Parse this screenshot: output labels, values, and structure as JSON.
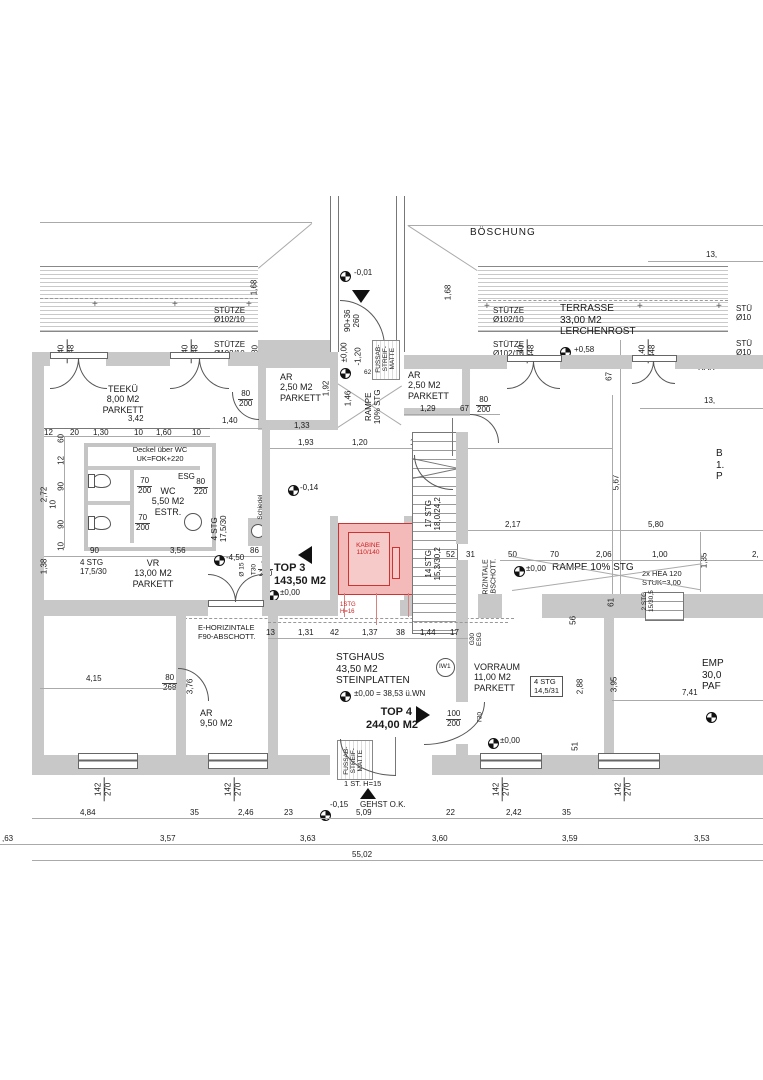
{
  "colors": {
    "wall": "#c8c8c8",
    "accent_red": "#cc3333"
  },
  "site": {
    "boeschung": "BÖSCHUNG",
    "dim_13a": "13,",
    "dim_13b": "13,",
    "rar": "RAR",
    "room_cut_1": "B",
    "room_cut_2": "1.",
    "room_cut_3": "P",
    "dim_2cut": "2,"
  },
  "rooms": {
    "terrasse": {
      "name": "TERRASSE",
      "area": "33,00 M2",
      "finish": "LERCHENROST"
    },
    "teekue": {
      "name": "TEEKÜ",
      "area": "8,00 M2",
      "finish": "PARKETT"
    },
    "ar_left": {
      "name": "AR",
      "area": "2,50 M2",
      "finish": "PARKETT"
    },
    "ar_right": {
      "name": "AR",
      "area": "2,50 M2",
      "finish": "PARKETT"
    },
    "wc": {
      "name": "WC",
      "area": "5,50 M2",
      "finish": "ESTR."
    },
    "vr": {
      "name": "VR",
      "area": "13,00 M2",
      "finish": "PARKETT"
    },
    "top3": {
      "name": "TOP 3",
      "area": "143,50 M2"
    },
    "top4": {
      "name": "TOP 4",
      "area": "244,00 M2"
    },
    "stghaus": {
      "name": "STGHAUS",
      "area": "43,50 M2",
      "finish": "STEINPLATTEN"
    },
    "vorraum": {
      "name": "VORRAUM",
      "area": "11,00 M2",
      "finish": "PARKETT"
    },
    "ar_bottom": {
      "name": "AR",
      "area": "9,50 M2"
    },
    "emp_cut": {
      "l1": "EMP",
      "l2": "30,0",
      "l3": "PAF"
    }
  },
  "columns": {
    "name": "STÜTZE",
    "size": "Ø102/10",
    "name_cut": "STÜ",
    "size_cut": "Ø10"
  },
  "elevator": {
    "name": "KABINE",
    "size": "110/140",
    "note": "1STG\nH=16"
  },
  "stairs": {
    "flight17": {
      "l1": "17 STG",
      "l2": "18,0/24,2"
    },
    "flight14": {
      "l1": "14 STG",
      "l2": "15,3/30,2"
    },
    "wc4": {
      "l1": "4 STG",
      "l2": "17,5/30"
    },
    "vr4": {
      "l1": "4 STG",
      "l2": "17,5/30"
    },
    "vorraum4": {
      "l1": "4 STG",
      "l2": "14,5/31"
    },
    "ramp2": {
      "l1": "2 STG",
      "l2": "15/30,5"
    },
    "ramp_main": "RAMPE 10% STG",
    "ramp_entry": {
      "l1": "RAMPE",
      "l2": "10% STG"
    },
    "hea": {
      "l1": "2x HEA 120",
      "l2": "STUK=3,00"
    },
    "step_note": "1 ST. H=15"
  },
  "levels": {
    "m001": "-0,01",
    "p058": "+0,58",
    "m014": "-0,14",
    "top3_zero": "±0,00",
    "m450": "-4,50",
    "ramp_zero": "±0,00",
    "stg_zero": "±0,00 = 38,53 ü.WN",
    "vorraum_zero": "±0,00",
    "m015": "-0,15",
    "gehst": "GEHST O.K.",
    "entry_zero": "±0,00",
    "entry_m120": "-1,20"
  },
  "tech": {
    "deckel": {
      "l1": "Deckel über WC",
      "l2": "UK=FOK+220"
    },
    "esg": "ESG",
    "g30": {
      "l1": "G30",
      "l2": "ESG"
    },
    "schiedel": {
      "l1": "Schiedel",
      "l2": "AVANT 16"
    },
    "ehoriz_h": {
      "l1": "E-HORIZINTALE",
      "l2": "F90-ABSCHOTT."
    },
    "ehoriz_v": {
      "l1": "E-HORIZINTALE",
      "l2": "F90-ABSCHOTT."
    },
    "mat": {
      "l1": "FUSSAB-",
      "l2": "STREIF-",
      "l3": "MATTE"
    },
    "iw1": "IW1",
    "t30_a": "T30",
    "t30_b": "T30",
    "o15": "Ø 15",
    "door_entry": {
      "l1": "90+36",
      "l2": "260"
    }
  },
  "fracs": {
    "f140_348": {
      "n": "140",
      "d": "348"
    },
    "f142_270": {
      "n": "142",
      "d": "270"
    },
    "f80_200": {
      "n": "80",
      "d": "200"
    },
    "f90_200": {
      "n": "90",
      "d": "200"
    },
    "f100_200": {
      "n": "100",
      "d": "200"
    },
    "f80_220": {
      "n": "80",
      "d": "220"
    },
    "f80_268": {
      "n": "80",
      "d": "268"
    },
    "f70_200": {
      "n": "70",
      "d": "200"
    }
  },
  "dims": {
    "wc_top": [
      "12",
      "20",
      "1,30",
      "10",
      "1,60",
      "10"
    ],
    "wc_left": [
      "60",
      "12",
      "90",
      "10",
      "90",
      "10"
    ],
    "top3_top": [
      "1,93",
      "1,20",
      "1,92"
    ],
    "stg_top": [
      "13",
      "1,31",
      "42",
      "1,37",
      "38",
      "1,44",
      "17"
    ],
    "ramp_row": [
      "50",
      "70",
      "2,06",
      "1,00"
    ],
    "bottom_row1": [
      "4,84",
      "35",
      "2,46",
      "23",
      "5,09",
      "22",
      "2,42",
      "35"
    ],
    "bottom_row2": [
      ",63",
      "3,57",
      "3,63",
      "3,60",
      "3,59",
      "3,53"
    ],
    "total": "55,02",
    "d342": "3,42",
    "d140": "1,40",
    "d133": "1,33",
    "d129": "1,29",
    "d67a": "67",
    "d67b": "67",
    "d168a": "1,68",
    "d168b": "1,68",
    "d80": "80",
    "d192": "1,92",
    "d356": "3,56",
    "d90": "90",
    "d86": "86",
    "d272": "2,72",
    "d138": "1,38",
    "d52": "52",
    "d31": "31",
    "d217": "2,17",
    "d580": "5,80",
    "d567": "5,67",
    "d135": "1,35",
    "d61": "61",
    "d56": "56",
    "d288": "2,88",
    "d395": "3,95",
    "d51": "51",
    "d50": "50",
    "d11": "11",
    "d741": "7,41",
    "d415": "4,15",
    "d376": "3,76",
    "d146": "1,46",
    "d62": "62"
  }
}
